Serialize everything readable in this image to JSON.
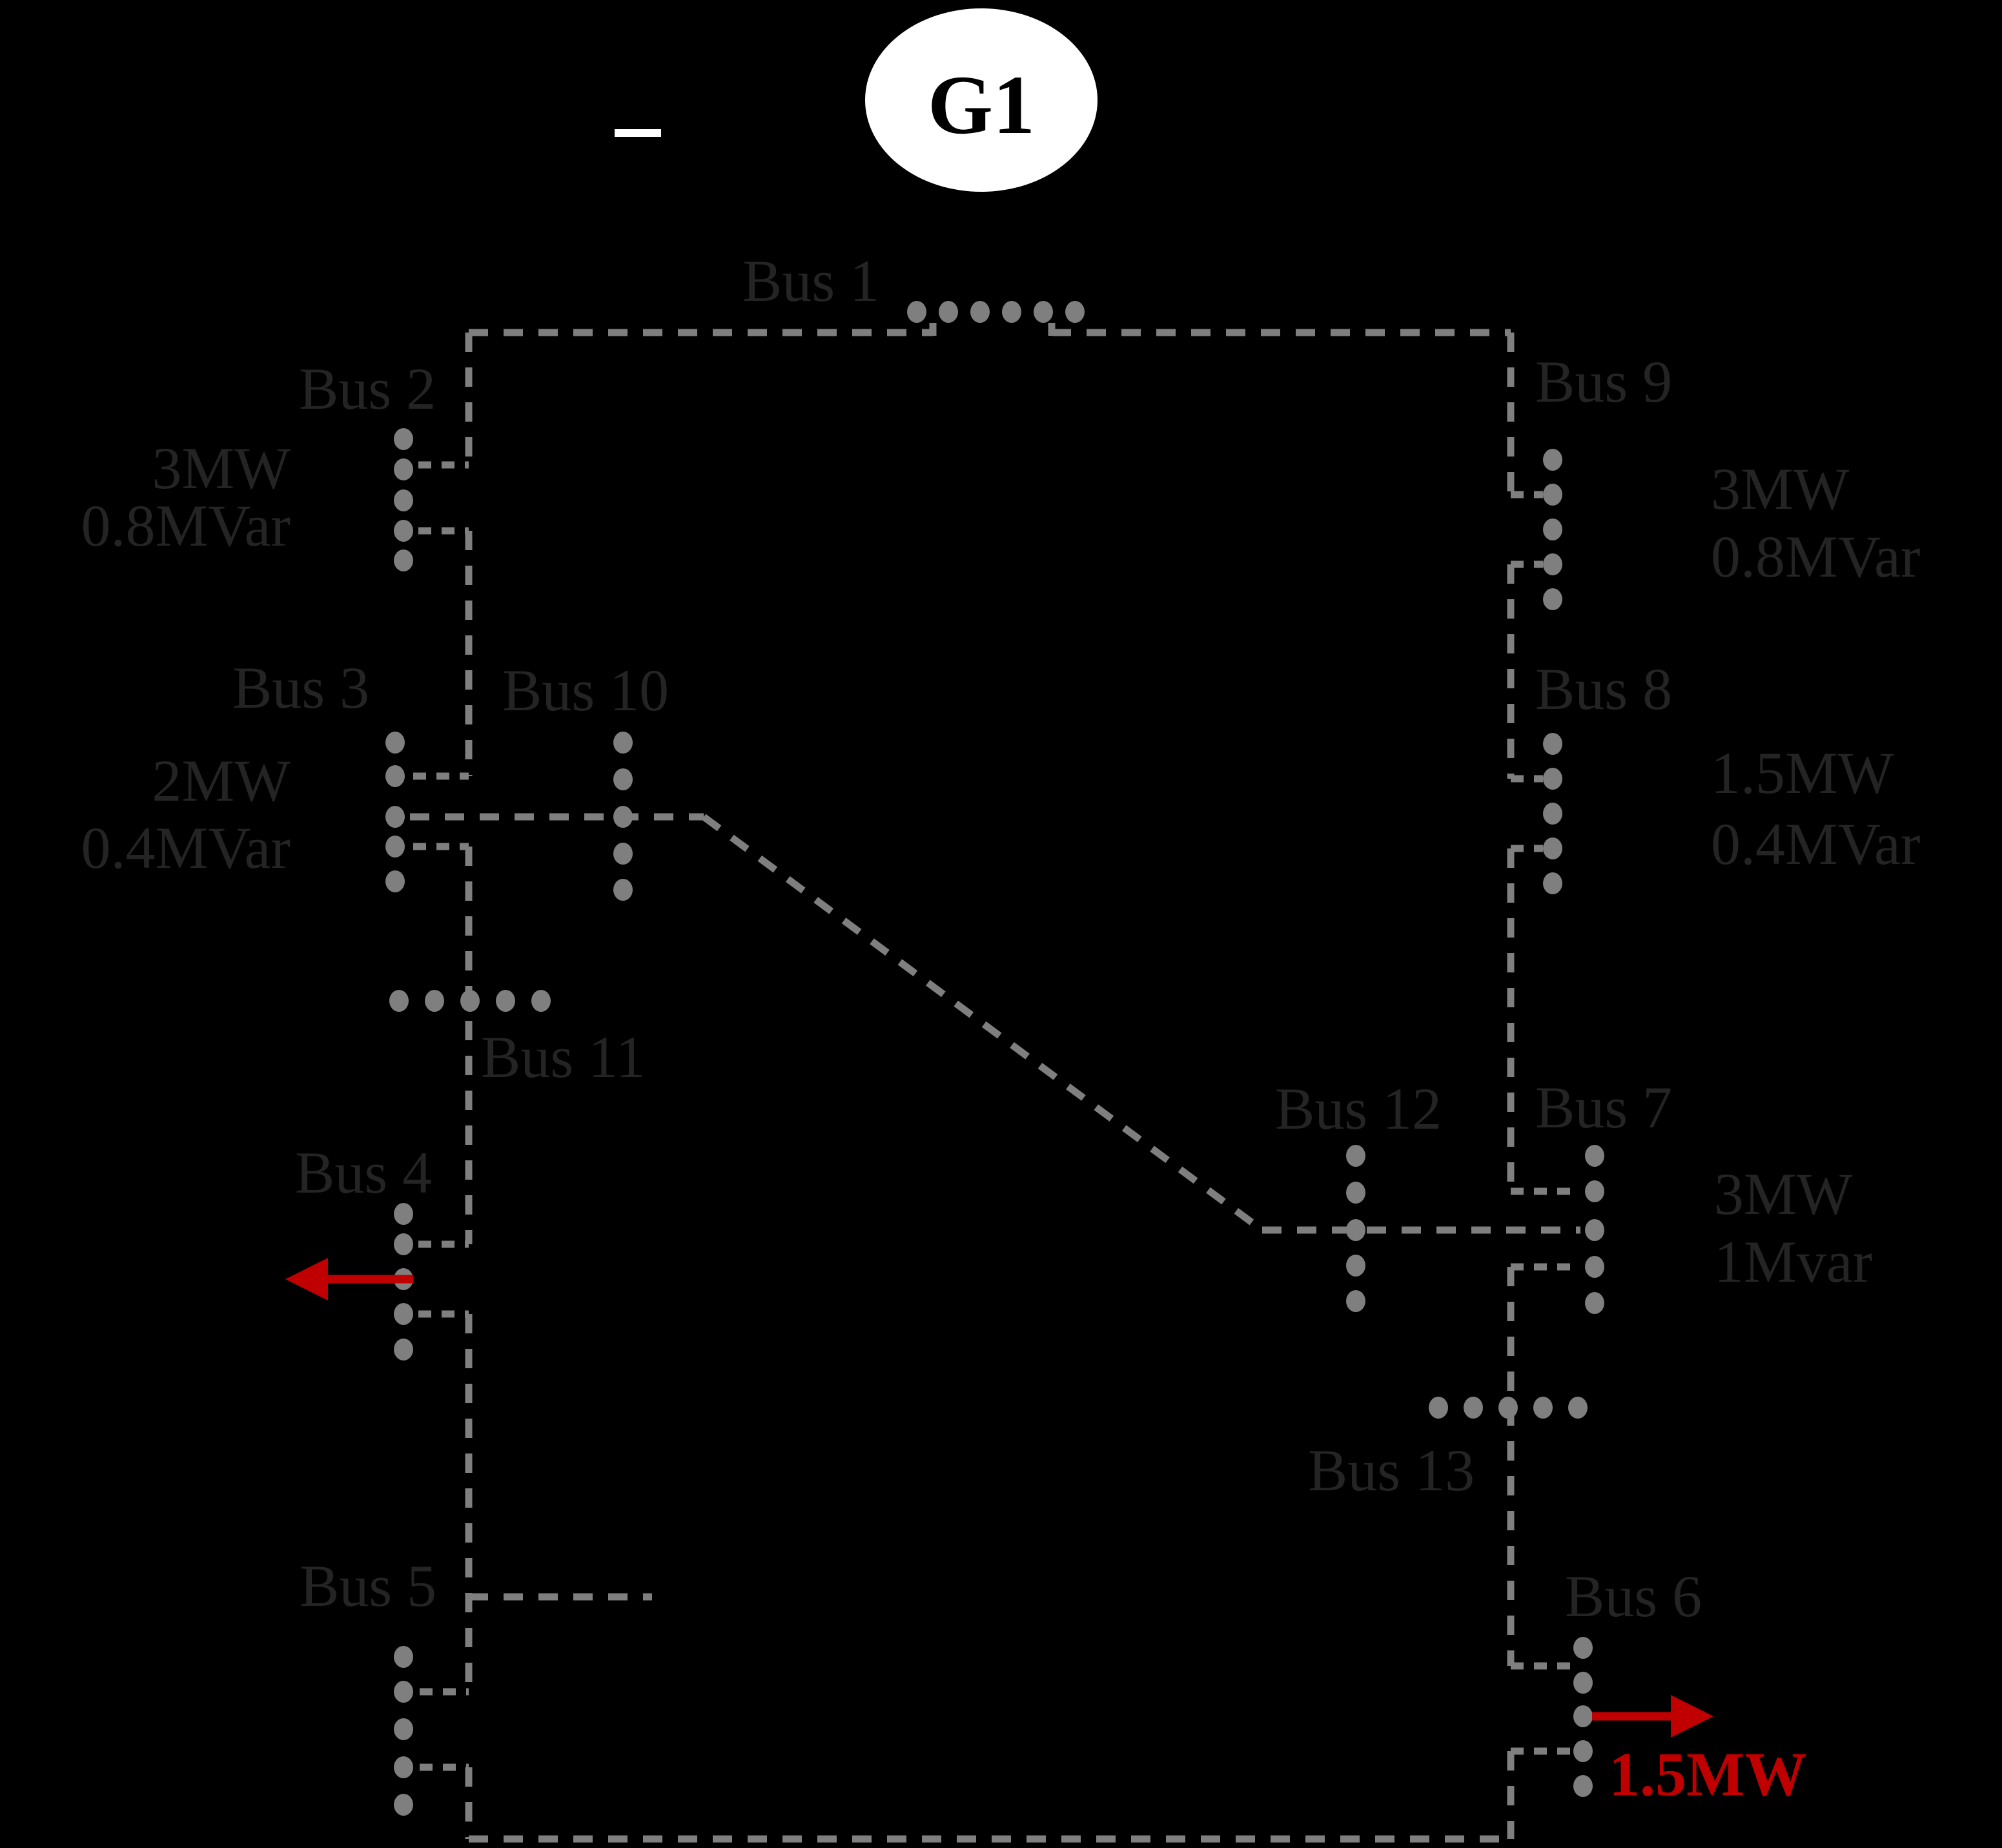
{
  "diagram_type": "power-system-one-line-diagram",
  "generator": {
    "label": "G1"
  },
  "buses": {
    "bus1": {
      "label": "Bus 1"
    },
    "bus2": {
      "label": "Bus 2"
    },
    "bus3": {
      "label": "Bus 3"
    },
    "bus4": {
      "label": "Bus 4"
    },
    "bus5": {
      "label": "Bus 5"
    },
    "bus6": {
      "label": "Bus 6"
    },
    "bus7": {
      "label": "Bus 7"
    },
    "bus8": {
      "label": "Bus 8"
    },
    "bus9": {
      "label": "Bus 9"
    },
    "bus10": {
      "label": "Bus 10"
    },
    "bus11": {
      "label": "Bus 11"
    },
    "bus12": {
      "label": "Bus 12"
    },
    "bus13": {
      "label": "Bus 13"
    }
  },
  "loads": {
    "bus2": {
      "p": "3MW",
      "q": "0.8MVar"
    },
    "bus3": {
      "p": "2MW",
      "q": "0.4MVar"
    },
    "bus9": {
      "p": "3MW",
      "q": "0.8MVar"
    },
    "bus8": {
      "p": "1.5MW",
      "q": "0.4MVar"
    },
    "bus7": {
      "p": "3MW",
      "q": "1Mvar"
    }
  },
  "red_loads": {
    "bus6": {
      "label": "1.5MW",
      "direction": "right"
    },
    "bus4": {
      "label": "",
      "direction": "left"
    }
  },
  "colors": {
    "background": "#000000",
    "line_gray": "#7f7f7f",
    "label_dark": "#242424",
    "red": "#c00000",
    "generator_fill": "#ffffff",
    "generator_text": "#000000"
  }
}
